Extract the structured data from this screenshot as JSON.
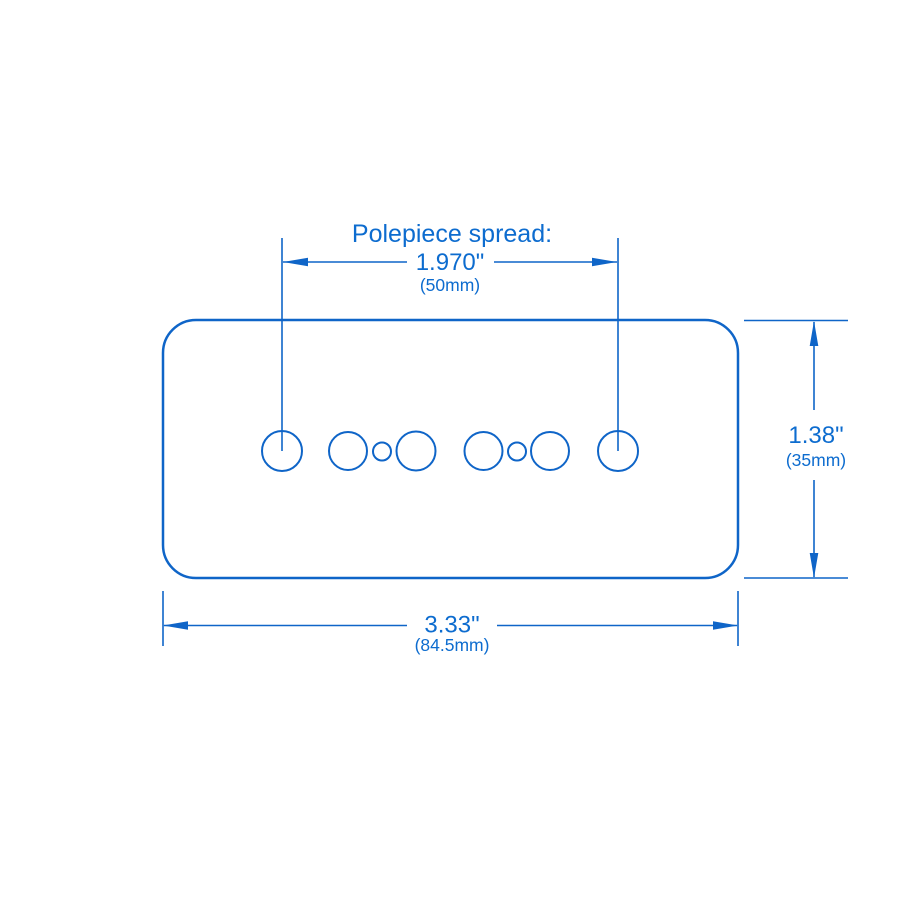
{
  "colors": {
    "line": "#0f65c8",
    "text": "#0d6ccf"
  },
  "title": "Polepiece spread:",
  "dimensions": {
    "polepiece_spread": {
      "inches": "1.970\"",
      "metric": "(50mm)"
    },
    "cover_width": {
      "inches": "3.33\"",
      "metric": "(84.5mm)"
    },
    "cover_height": {
      "inches": "1.38\"",
      "metric": "(35mm)"
    }
  }
}
